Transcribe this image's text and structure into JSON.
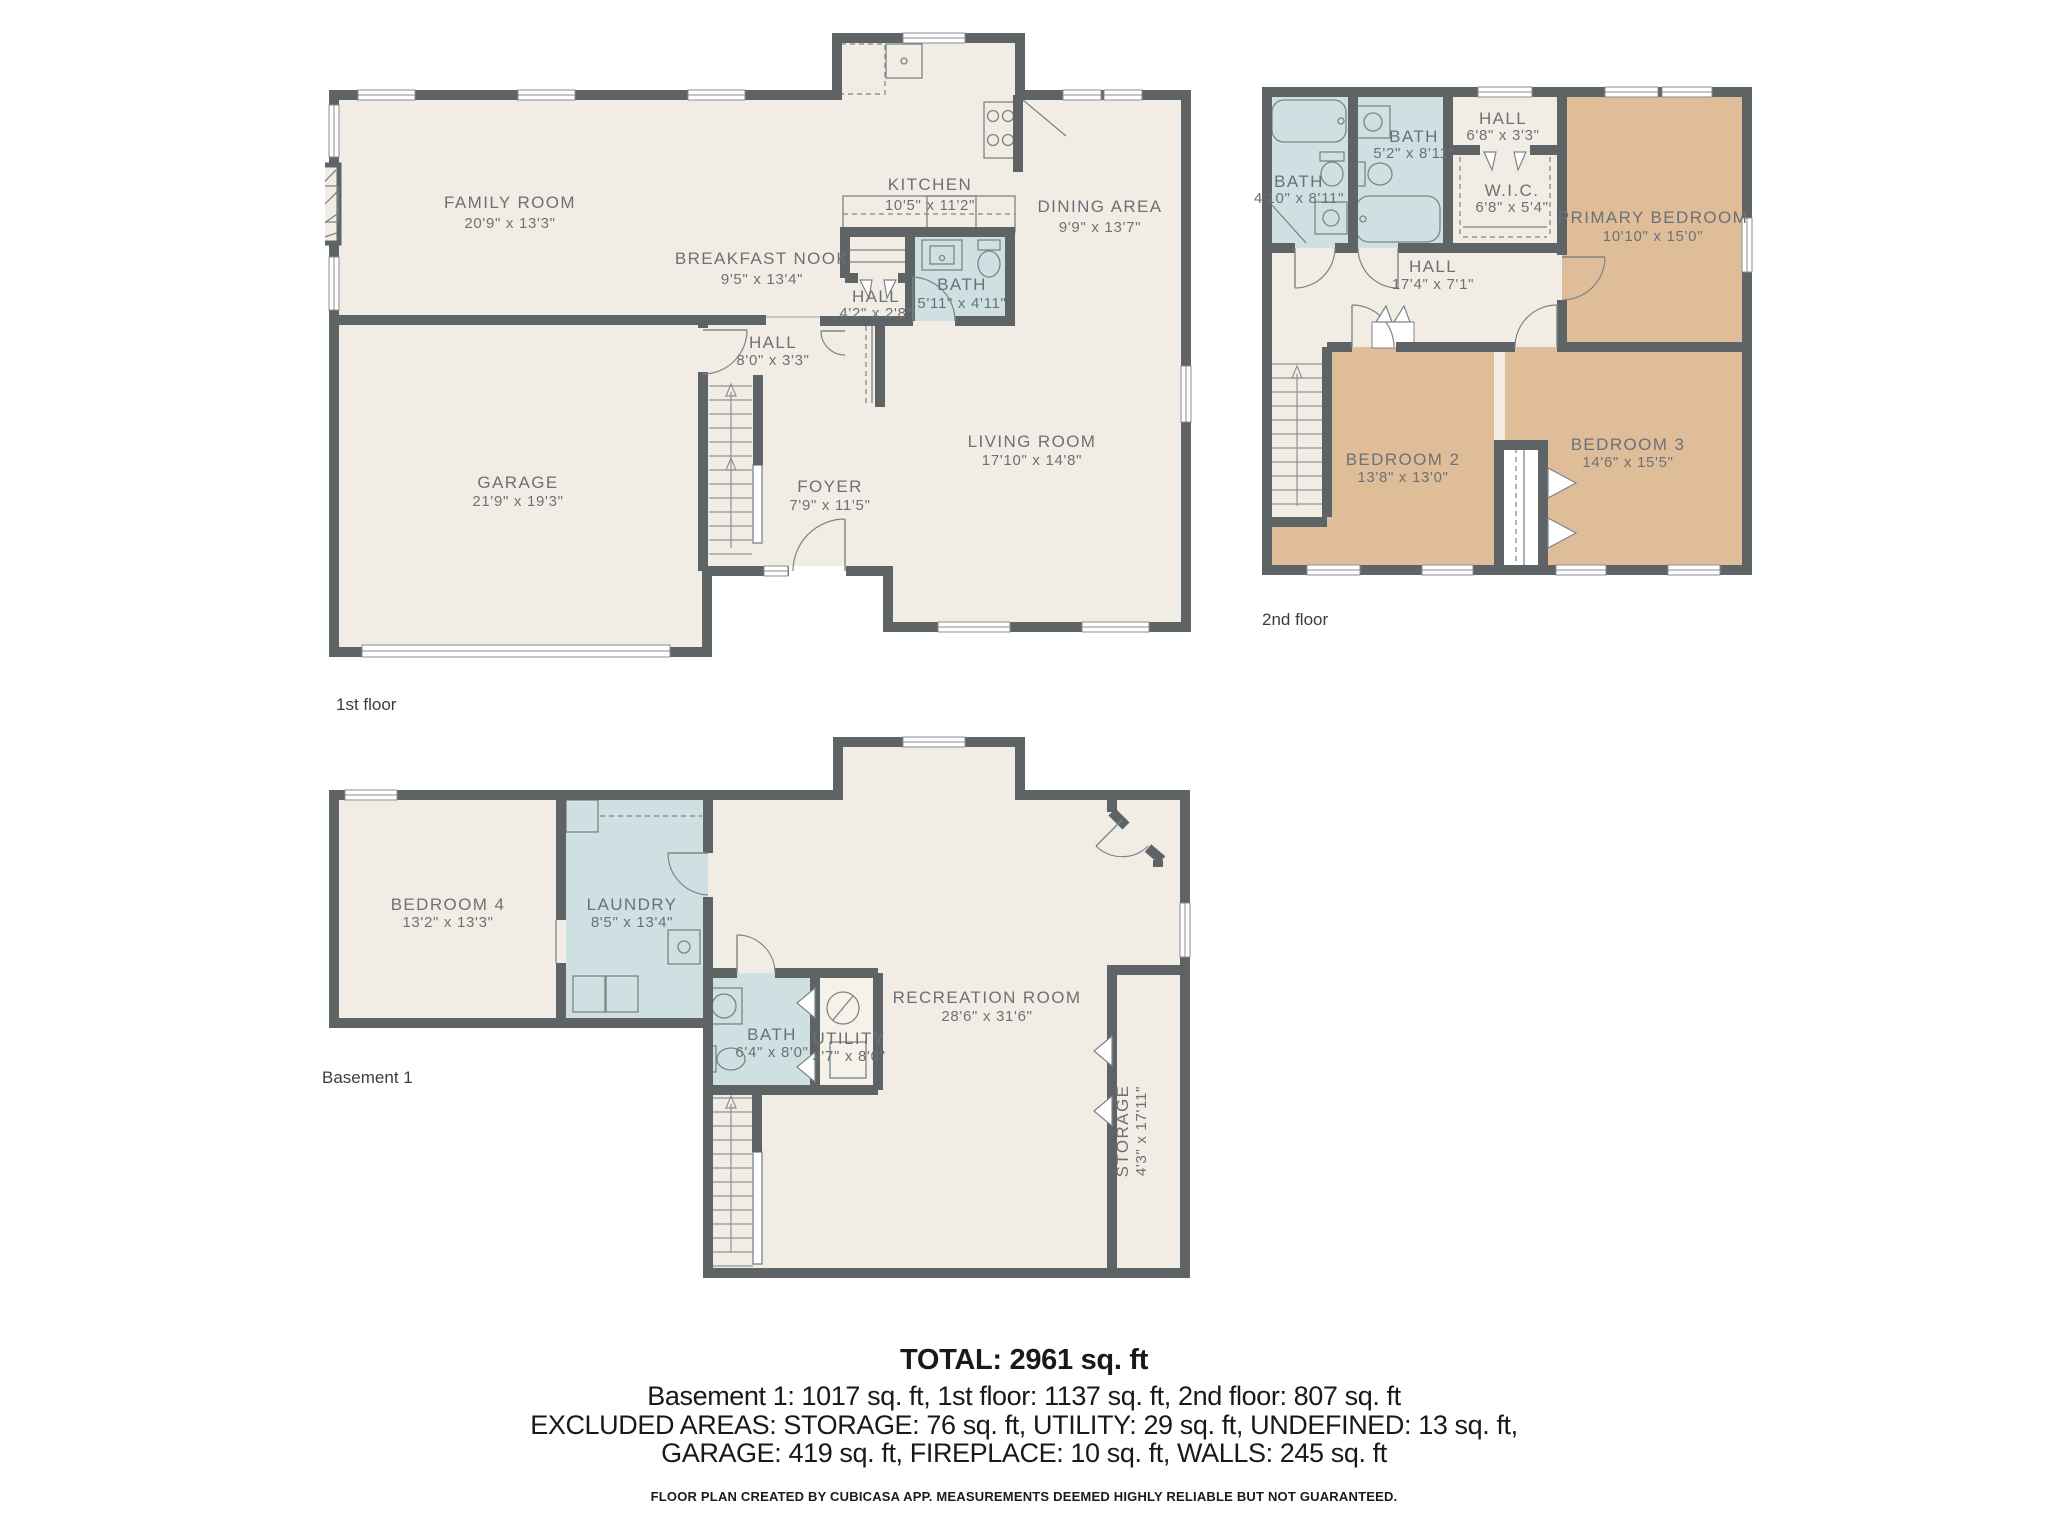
{
  "colors": {
    "wall": "#5E6366",
    "room_beige": "#F2EDE4",
    "room_tan": "#DFBD99",
    "room_wet_blue": "#CEE0E2",
    "label_gray": "#6B7176",
    "summary_text": "#17191C"
  },
  "floors": [
    {
      "caption": "1st floor",
      "rooms": [
        {
          "name": "FAMILY ROOM",
          "dims": "20'9\" x 13'3\""
        },
        {
          "name": "BREAKFAST NOOK",
          "dims": "9'5\" x 13'4\""
        },
        {
          "name": "KITCHEN",
          "dims": "10'5\" x 11'2\""
        },
        {
          "name": "DINING AREA",
          "dims": "9'9\" x 13'7\""
        },
        {
          "name": "HALL",
          "dims": "4'2\" x 2'8\""
        },
        {
          "name": "BATH",
          "dims": "5'11\" x 4'11\""
        },
        {
          "name": "HALL",
          "dims": "8'0\" x 3'3\""
        },
        {
          "name": "GARAGE",
          "dims": "21'9\" x 19'3\""
        },
        {
          "name": "FOYER",
          "dims": "7'9\" x 11'5\""
        },
        {
          "name": "LIVING ROOM",
          "dims": "17'10\" x 14'8\""
        }
      ]
    },
    {
      "caption": "2nd floor",
      "rooms": [
        {
          "name": "BATH",
          "dims": "4'10\" x 8'11\""
        },
        {
          "name": "BATH",
          "dims": "5'2\" x 8'11\""
        },
        {
          "name": "HALL",
          "dims": "6'8\" x 3'3\""
        },
        {
          "name": "W.I.C.",
          "dims": "6'8\" x 5'4\""
        },
        {
          "name": "PRIMARY BEDROOM",
          "dims": "10'10\" x 15'0\""
        },
        {
          "name": "HALL",
          "dims": "17'4\" x 7'1\""
        },
        {
          "name": "BEDROOM 2",
          "dims": "13'8\" x 13'0\""
        },
        {
          "name": "BEDROOM 3",
          "dims": "14'6\" x 15'5\""
        }
      ]
    },
    {
      "caption": "Basement 1",
      "rooms": [
        {
          "name": "BEDROOM 4",
          "dims": "13'2\" x 13'3\""
        },
        {
          "name": "LAUNDRY",
          "dims": "8'5\" x 13'4\""
        },
        {
          "name": "BATH",
          "dims": "6'4\" x 8'0\""
        },
        {
          "name": "UTILITY",
          "dims": "3'7\" x 8'0\""
        },
        {
          "name": "RECREATION ROOM",
          "dims": "28'6\" x 31'6\""
        },
        {
          "name": "STORAGE",
          "dims": "4'3\" x 17'11\""
        }
      ]
    }
  ],
  "summary": {
    "total": "TOTAL: 2961 sq. ft",
    "line1": "Basement 1: 1017 sq. ft, 1st floor: 1137 sq. ft, 2nd floor: 807 sq. ft",
    "line2": "EXCLUDED AREAS: STORAGE: 76 sq. ft, UTILITY: 29 sq. ft, UNDEFINED: 13 sq. ft,",
    "line3": "GARAGE: 419 sq. ft, FIREPLACE: 10 sq. ft, WALLS: 245 sq. ft",
    "disclaimer": "FLOOR PLAN CREATED BY CUBICASA APP. MEASUREMENTS DEEMED HIGHLY RELIABLE BUT NOT GUARANTEED."
  }
}
